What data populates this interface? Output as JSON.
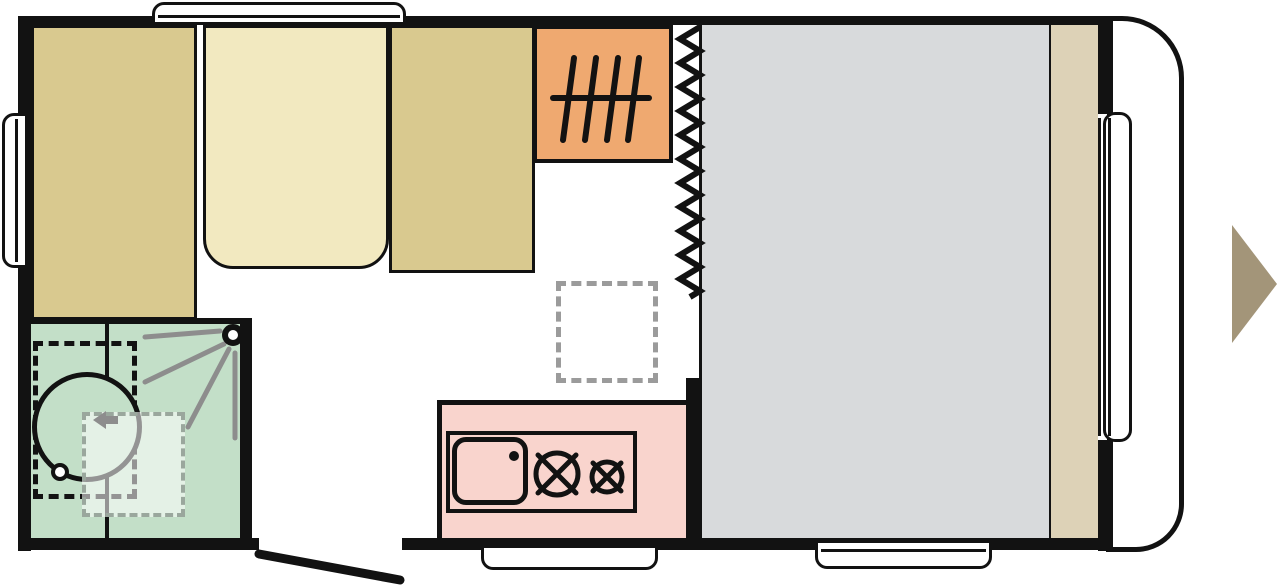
{
  "diagram": {
    "kind": "caravan floor plan",
    "travel_direction": "right"
  },
  "colors": {
    "bg": "#ffffff",
    "line": "#121212",
    "seat": "#d9c98f",
    "cushion": "#f2e9c0",
    "wardrobe": "#efa970",
    "bathroom": "#c3dfc8",
    "overlay": "rgba(255,255,255,0.55)",
    "overlaydash": "#9aa79d",
    "kitchen": "#f9d4cd",
    "bed": "#d8dadc",
    "trim": "#ddd2b7",
    "arrowtan": "#a39579",
    "swing": "#8d8d8d",
    "tabledash": "#9b9b9b"
  },
  "features": [
    {
      "id": "bench-seat-left",
      "color_key": "seat"
    },
    {
      "id": "seat-cushion-middle",
      "color_key": "cushion"
    },
    {
      "id": "bench-seat-right",
      "color_key": "seat"
    },
    {
      "id": "wardrobe-with-hanger-rail",
      "color_key": "wardrobe"
    },
    {
      "id": "bathroom-with-swivel-shower",
      "color_key": "bathroom"
    },
    {
      "id": "dinette-table-folded-outline",
      "color_key": "tabledash"
    },
    {
      "id": "kitchen-unit-sink-and-two-burner-hob",
      "color_key": "kitchen"
    },
    {
      "id": "curtain-divider-zigzag",
      "color_key": "line"
    },
    {
      "id": "fixed-bed",
      "color_key": "bed"
    },
    {
      "id": "side-trim-shelf",
      "color_key": "trim"
    },
    {
      "id": "entrance-door-open",
      "color_key": "line"
    },
    {
      "id": "windows",
      "count": 4
    },
    {
      "id": "entry-step",
      "count": 1
    },
    {
      "id": "travel-direction-arrow",
      "color_key": "arrowtan"
    }
  ]
}
